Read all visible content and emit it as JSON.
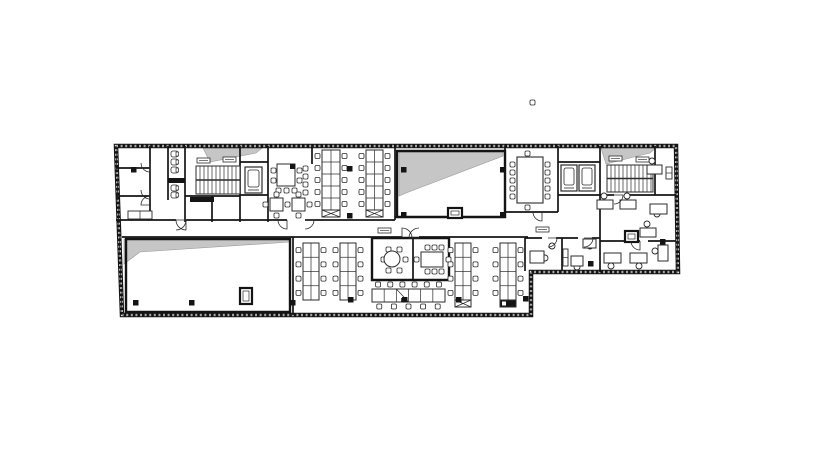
{
  "meta": {
    "drawing_type": "office-floor-plan",
    "canvas_w": 818,
    "canvas_h": 466,
    "colors": {
      "background": "#ffffff",
      "wall": "#141414",
      "thin": "#2b2b2b",
      "shade": "#c6c6c6",
      "furniture": "#2b2b2b"
    }
  },
  "plan": {
    "outline": [
      [
        116,
        146
      ],
      [
        676,
        146
      ],
      [
        678,
        272
      ],
      [
        531,
        272
      ],
      [
        531,
        315
      ],
      [
        122,
        315
      ]
    ],
    "shades": [
      [
        [
          203,
          148
        ],
        [
          262,
          148
        ],
        [
          256,
          153
        ],
        [
          210,
          162
        ]
      ],
      [
        [
          399,
          152
        ],
        [
          503,
          152
        ],
        [
          503,
          156
        ],
        [
          406,
          193
        ],
        [
          399,
          196
        ]
      ],
      [
        [
          601,
          148
        ],
        [
          656,
          148
        ],
        [
          650,
          153
        ],
        [
          606,
          164
        ]
      ],
      [
        [
          124,
          239
        ],
        [
          290,
          239
        ],
        [
          290,
          242
        ],
        [
          140,
          252
        ],
        [
          124,
          264
        ]
      ]
    ],
    "thick_rooms": [
      [
        [
          397,
          151
        ],
        [
          505,
          151
        ],
        [
          505,
          217
        ],
        [
          397,
          217
        ]
      ],
      [
        [
          126,
          239
        ],
        [
          290,
          239
        ],
        [
          290,
          312
        ],
        [
          126,
          312
        ]
      ],
      [
        [
          372,
          238
        ],
        [
          449,
          238
        ],
        [
          449,
          280
        ],
        [
          372,
          280
        ]
      ]
    ],
    "walls": [
      [
        150,
        146,
        150,
        218
      ],
      [
        168,
        146,
        168,
        200
      ],
      [
        185,
        146,
        185,
        222
      ],
      [
        240,
        146,
        240,
        222
      ],
      [
        268,
        146,
        268,
        222
      ],
      [
        312,
        146,
        312,
        164
      ],
      [
        395,
        146,
        395,
        220
      ],
      [
        505,
        146,
        505,
        217
      ],
      [
        558,
        146,
        558,
        212
      ],
      [
        600,
        146,
        600,
        272
      ],
      [
        655,
        146,
        655,
        195
      ],
      [
        116,
        168,
        150,
        168
      ],
      [
        116,
        196,
        150,
        196
      ],
      [
        185,
        196,
        240,
        196
      ],
      [
        212,
        196,
        212,
        222
      ],
      [
        240,
        162,
        268,
        162
      ],
      [
        240,
        195,
        268,
        195
      ],
      [
        116,
        220,
        176,
        220
      ],
      [
        186,
        220,
        287,
        220
      ],
      [
        305,
        220,
        395,
        220
      ],
      [
        395,
        217,
        505,
        217
      ],
      [
        505,
        212,
        558,
        212
      ],
      [
        558,
        195,
        600,
        195
      ],
      [
        558,
        162,
        600,
        162
      ],
      [
        600,
        195,
        614,
        195
      ],
      [
        628,
        195,
        676,
        195
      ],
      [
        600,
        241,
        640,
        241
      ],
      [
        648,
        241,
        676,
        241
      ],
      [
        525,
        238,
        542,
        238
      ],
      [
        556,
        238,
        578,
        238
      ],
      [
        592,
        238,
        600,
        238
      ],
      [
        525,
        238,
        525,
        271
      ],
      [
        562,
        238,
        562,
        271
      ],
      [
        122,
        237,
        293,
        237
      ],
      [
        293,
        237,
        402,
        237
      ],
      [
        419,
        237,
        528,
        237
      ],
      [
        293,
        237,
        293,
        315
      ],
      [
        413,
        238,
        413,
        280
      ]
    ],
    "wall_rects": [
      [
        168,
        178,
        17,
        5
      ],
      [
        190,
        197,
        24,
        5
      ]
    ],
    "stairs": [
      {
        "x": 196,
        "y": 166,
        "w": 44,
        "h": 28
      },
      {
        "x": 607,
        "y": 165,
        "w": 46,
        "h": 27
      }
    ],
    "elevators": [
      {
        "x": 245,
        "y": 167,
        "w": 17,
        "h": 26
      },
      {
        "x": 561,
        "y": 165,
        "w": 16,
        "h": 26
      },
      {
        "x": 579,
        "y": 165,
        "w": 16,
        "h": 26
      }
    ],
    "toilets": [
      [
        171,
        151
      ],
      [
        171,
        159
      ],
      [
        171,
        167
      ],
      [
        171,
        185
      ],
      [
        171,
        192
      ]
    ],
    "benches_v": [
      {
        "x": 322,
        "y": 150,
        "w": 18,
        "h": 60,
        "rows": 5,
        "xcell": true,
        "dark": false
      },
      {
        "x": 366,
        "y": 150,
        "w": 17,
        "h": 60,
        "rows": 5,
        "xcell": true,
        "dark": false
      },
      {
        "x": 303,
        "y": 243,
        "w": 16,
        "h": 57,
        "rows": 4,
        "xcell": false,
        "dark": false
      },
      {
        "x": 340,
        "y": 243,
        "w": 16,
        "h": 57,
        "rows": 4,
        "xcell": false,
        "dark": false
      },
      {
        "x": 455,
        "y": 243,
        "w": 16,
        "h": 57,
        "rows": 4,
        "xcell": true,
        "dark": false
      },
      {
        "x": 500,
        "y": 243,
        "w": 16,
        "h": 57,
        "rows": 4,
        "xcell": true,
        "dark": true
      }
    ],
    "bench_h": {
      "x": 372,
      "y": 289,
      "w": 73,
      "h": 13,
      "cols": 6,
      "chairs_top": 6,
      "chairs_bottom": 5
    },
    "island": {
      "x": 277,
      "y": 164,
      "w": 18,
      "h": 22
    },
    "square_tables": [
      {
        "x": 270,
        "y": 198,
        "w": 13,
        "h": 13
      },
      {
        "x": 292,
        "y": 198,
        "w": 13,
        "h": 13
      }
    ],
    "conference_table": {
      "x": 517,
      "y": 157,
      "w": 26,
      "h": 46
    },
    "round_table": {
      "cx": 392,
      "cy": 259,
      "r": 8
    },
    "meeting_table": {
      "x": 421,
      "y": 252,
      "w": 22,
      "h": 15
    },
    "chairs": [
      [
        271,
        168
      ],
      [
        271,
        178
      ],
      [
        297,
        168
      ],
      [
        297,
        178
      ],
      [
        276,
        188
      ],
      [
        284,
        188
      ],
      [
        292,
        188
      ],
      [
        303,
        166
      ],
      [
        303,
        174
      ],
      [
        303,
        182
      ],
      [
        303,
        190
      ],
      [
        274,
        192
      ],
      [
        274,
        213
      ],
      [
        263,
        202
      ],
      [
        285,
        202
      ],
      [
        296,
        192
      ],
      [
        296,
        213
      ],
      [
        307,
        202
      ],
      [
        510,
        162
      ],
      [
        510,
        170
      ],
      [
        510,
        178
      ],
      [
        510,
        186
      ],
      [
        510,
        194
      ],
      [
        545,
        162
      ],
      [
        545,
        170
      ],
      [
        545,
        178
      ],
      [
        545,
        186
      ],
      [
        545,
        194
      ],
      [
        525,
        151
      ],
      [
        525,
        205
      ],
      [
        403,
        257
      ],
      [
        397,
        268
      ],
      [
        386,
        268
      ],
      [
        381,
        257
      ],
      [
        386,
        247
      ],
      [
        397,
        247
      ],
      [
        425,
        245
      ],
      [
        432,
        245
      ],
      [
        439,
        245
      ],
      [
        425,
        269
      ],
      [
        432,
        269
      ],
      [
        439,
        269
      ],
      [
        414,
        257
      ],
      [
        446,
        257
      ],
      [
        530,
        100
      ]
    ],
    "chair_circles": [
      [
        604,
        196
      ],
      [
        627,
        196
      ],
      [
        657,
        214
      ],
      [
        647,
        224
      ],
      [
        611,
        266
      ],
      [
        639,
        266
      ],
      [
        655,
        251
      ],
      [
        652,
        161
      ],
      [
        536,
        258
      ],
      [
        545,
        258
      ],
      [
        552,
        246
      ],
      [
        577,
        267
      ],
      [
        590,
        246
      ],
      [
        617,
        257
      ]
    ],
    "desks": [
      [
        597,
        200,
        16,
        9
      ],
      [
        620,
        200,
        16,
        9
      ],
      [
        650,
        204,
        17,
        10
      ],
      [
        640,
        228,
        16,
        9
      ],
      [
        604,
        253,
        17,
        10
      ],
      [
        630,
        253,
        17,
        10
      ],
      [
        658,
        245,
        10,
        16
      ],
      [
        647,
        165,
        15,
        9
      ],
      [
        530,
        251,
        14,
        12
      ],
      [
        571,
        256,
        12,
        10
      ],
      [
        583,
        239,
        13,
        9
      ]
    ],
    "cabinets": [
      [
        128,
        211,
        24,
        8
      ],
      [
        563,
        249,
        5,
        17
      ],
      [
        666,
        167,
        6,
        12
      ]
    ],
    "boxes": [
      [
        240,
        288,
        12,
        16
      ],
      [
        448,
        208,
        14,
        10
      ],
      [
        625,
        231,
        13,
        11
      ]
    ],
    "columns": [
      [
        347,
        166
      ],
      [
        347,
        213
      ],
      [
        401,
        167
      ],
      [
        500,
        167
      ],
      [
        401,
        212
      ],
      [
        500,
        212
      ],
      [
        133,
        300
      ],
      [
        189,
        300
      ],
      [
        290,
        300
      ],
      [
        348,
        297
      ],
      [
        402,
        297
      ],
      [
        456,
        297
      ],
      [
        523,
        296
      ],
      [
        588,
        261
      ],
      [
        660,
        239
      ],
      [
        131,
        167
      ]
    ],
    "tags": [
      [
        197,
        158
      ],
      [
        223,
        157
      ],
      [
        609,
        156
      ],
      [
        636,
        157
      ],
      [
        378,
        228
      ],
      [
        536,
        227
      ]
    ],
    "doors": [
      [
        176,
        220,
        10,
        0,
        90
      ],
      [
        186,
        220,
        10,
        90,
        180
      ],
      [
        287,
        220,
        9,
        90,
        180
      ],
      [
        305,
        220,
        9,
        0,
        90
      ],
      [
        402,
        238,
        10,
        270,
        360
      ],
      [
        419,
        238,
        10,
        180,
        270
      ],
      [
        542,
        212,
        9,
        90,
        180
      ],
      [
        548,
        238,
        9,
        0,
        90
      ],
      [
        584,
        238,
        9,
        0,
        90
      ],
      [
        614,
        195,
        9,
        0,
        90
      ],
      [
        150,
        205,
        9,
        180,
        270
      ],
      [
        640,
        241,
        9,
        90,
        180
      ],
      [
        150,
        163,
        9,
        90,
        180
      ],
      [
        150,
        190,
        9,
        90,
        180
      ]
    ]
  }
}
